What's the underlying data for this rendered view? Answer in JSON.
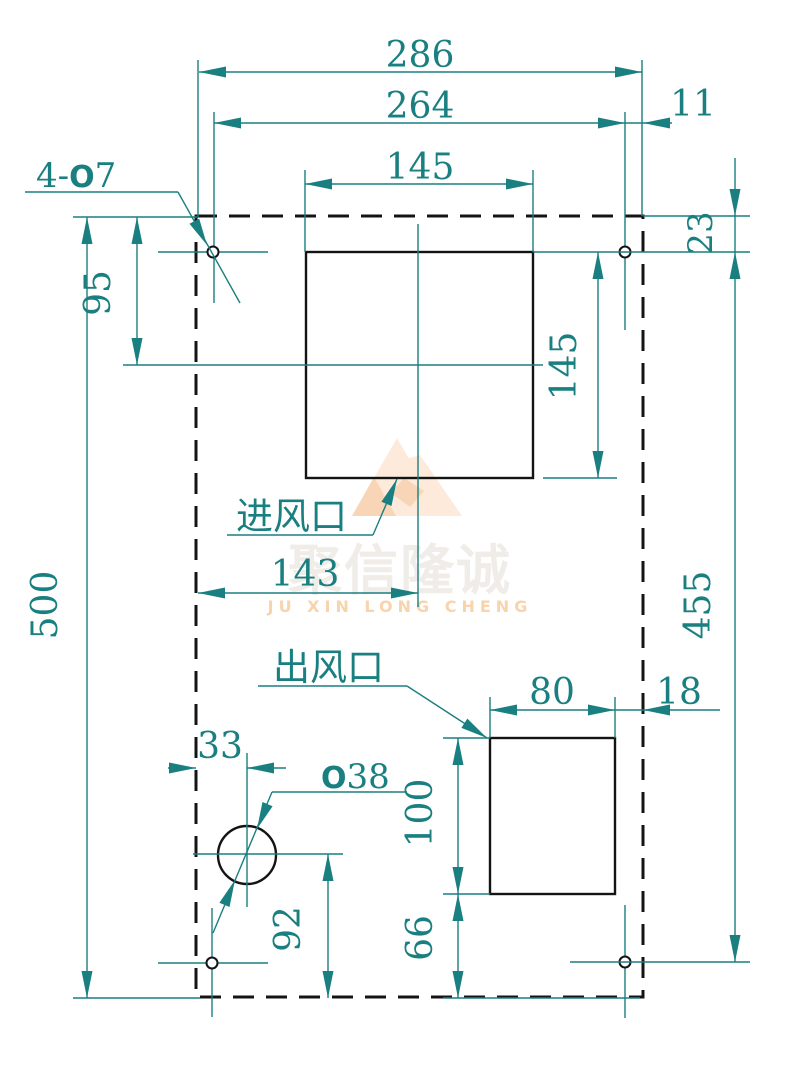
{
  "watermark": {
    "cn": "聚信隆诚",
    "en": "JU XIN LONG CHENG"
  },
  "labels": {
    "holes_prefix": "4-",
    "holes_sym": "O",
    "holes_size": "7",
    "inlet": "进风口",
    "outlet": "出风口",
    "circle_sym": "O",
    "circle_size": "38"
  },
  "dims": {
    "overall_width": "286",
    "hole_span_width": "264",
    "hole_edge_right": "11",
    "inlet_width": "145",
    "inlet_height": "145",
    "inlet_center_from_top": "95",
    "overall_height": "500",
    "hole_from_top": "23",
    "hole_span_height": "455",
    "inlet_center_from_left": "143",
    "outlet_width": "80",
    "outlet_edge_right": "18",
    "circle_from_left": "33",
    "outlet_height": "100",
    "circle_from_bottom": "92",
    "outlet_from_bottom": "66"
  },
  "colors": {
    "dimension_teal": "#1a7f80",
    "line_black": "#141414",
    "watermark_pale_peach": "#fdeadb",
    "watermark_peach": "#f8d5b6",
    "watermark_text_gray": "#f0ede9",
    "watermark_text_orange": "#f8d3ab"
  }
}
